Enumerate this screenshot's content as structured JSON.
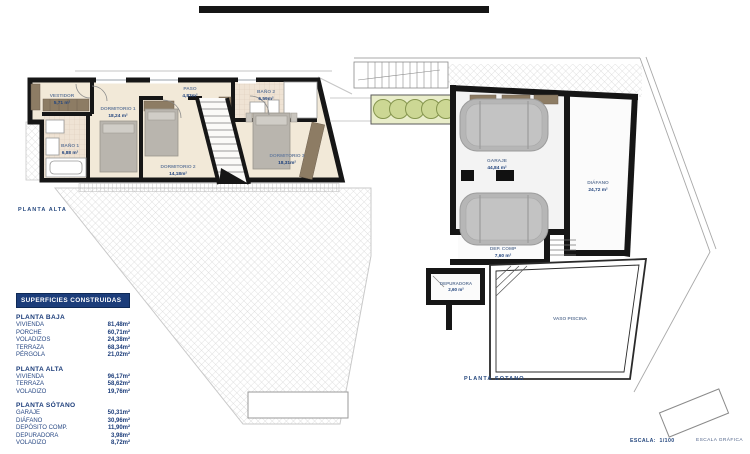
{
  "document": {
    "type": "architectural floor plans",
    "background": "#ffffff"
  },
  "colors": {
    "wall_black": "#161616",
    "floor_beige": "#f2e9d8",
    "tile": "#efe3d4",
    "furniture_gray": "#b9b5ae",
    "closet_tan": "#8d7c64",
    "hatch_gray": "#d6d6d6",
    "planter_green": "#ccd794",
    "table_navy": "#1c3d7a",
    "label_blue": "#27497f"
  },
  "left_plan": {
    "title": "PLANTA ALTA",
    "rooms": [
      {
        "name": "VESTIDOR",
        "area": "5,71 m²"
      },
      {
        "name": "DORMITORIO 1",
        "area": "18,24 m²"
      },
      {
        "name": "BAÑO 1",
        "area": "6,88 m²"
      },
      {
        "name": "PASO",
        "area": "4,83m²"
      },
      {
        "name": "BAÑO 2",
        "area": "6,59m²"
      },
      {
        "name": "DORMITORIO 2",
        "area": "14,18m²"
      },
      {
        "name": "DORMITORIO 3",
        "area": "18,31m²"
      }
    ]
  },
  "right_plan": {
    "title": "PLANTA SOTANO",
    "rooms": [
      {
        "name": "GARAJE",
        "area": "44,84 m²"
      },
      {
        "name": "DIÁFANO",
        "area": "24,72 m²"
      },
      {
        "name": "DEP. COMP",
        "area": "7,60 m²"
      },
      {
        "name": "DEPURADORA",
        "area": "2,60 m²"
      },
      {
        "name": "VASO PISCINA",
        "area": ""
      }
    ]
  },
  "surfaces_table": {
    "title": "SUPERFICIES CONSTRUIDAS",
    "sections": [
      {
        "heading": "PLANTA BAJA",
        "rows": [
          [
            "VIVIENDA",
            "81,48m²"
          ],
          [
            "PORCHE",
            "60,71m²"
          ],
          [
            "VOLADIZOS",
            "24,38m²"
          ],
          [
            "TERRAZA",
            "68,34m²"
          ],
          [
            "PÉRGOLA",
            "21,02m²"
          ]
        ]
      },
      {
        "heading": "PLANTA ALTA",
        "rows": [
          [
            "VIVIENDA",
            "96,17m²"
          ],
          [
            "TERRAZA",
            "58,62m²"
          ],
          [
            "VOLADIZO",
            "19,76m²"
          ]
        ]
      },
      {
        "heading": "PLANTA SÓTANO",
        "rows": [
          [
            "GARAJE",
            "50,31m²"
          ],
          [
            "DIÁFANO",
            "30,96m²"
          ],
          [
            "DEPÓSITO COMP.",
            "11,90m²"
          ],
          [
            "DEPURADORA",
            "3,98m²"
          ],
          [
            "VOLADIZO",
            "8,72m²"
          ]
        ]
      }
    ]
  },
  "footer": {
    "scale_label": "ESCALA:",
    "scale_value": "1/100",
    "graphic_scale_label": "ESCALA GRÁFICA"
  }
}
